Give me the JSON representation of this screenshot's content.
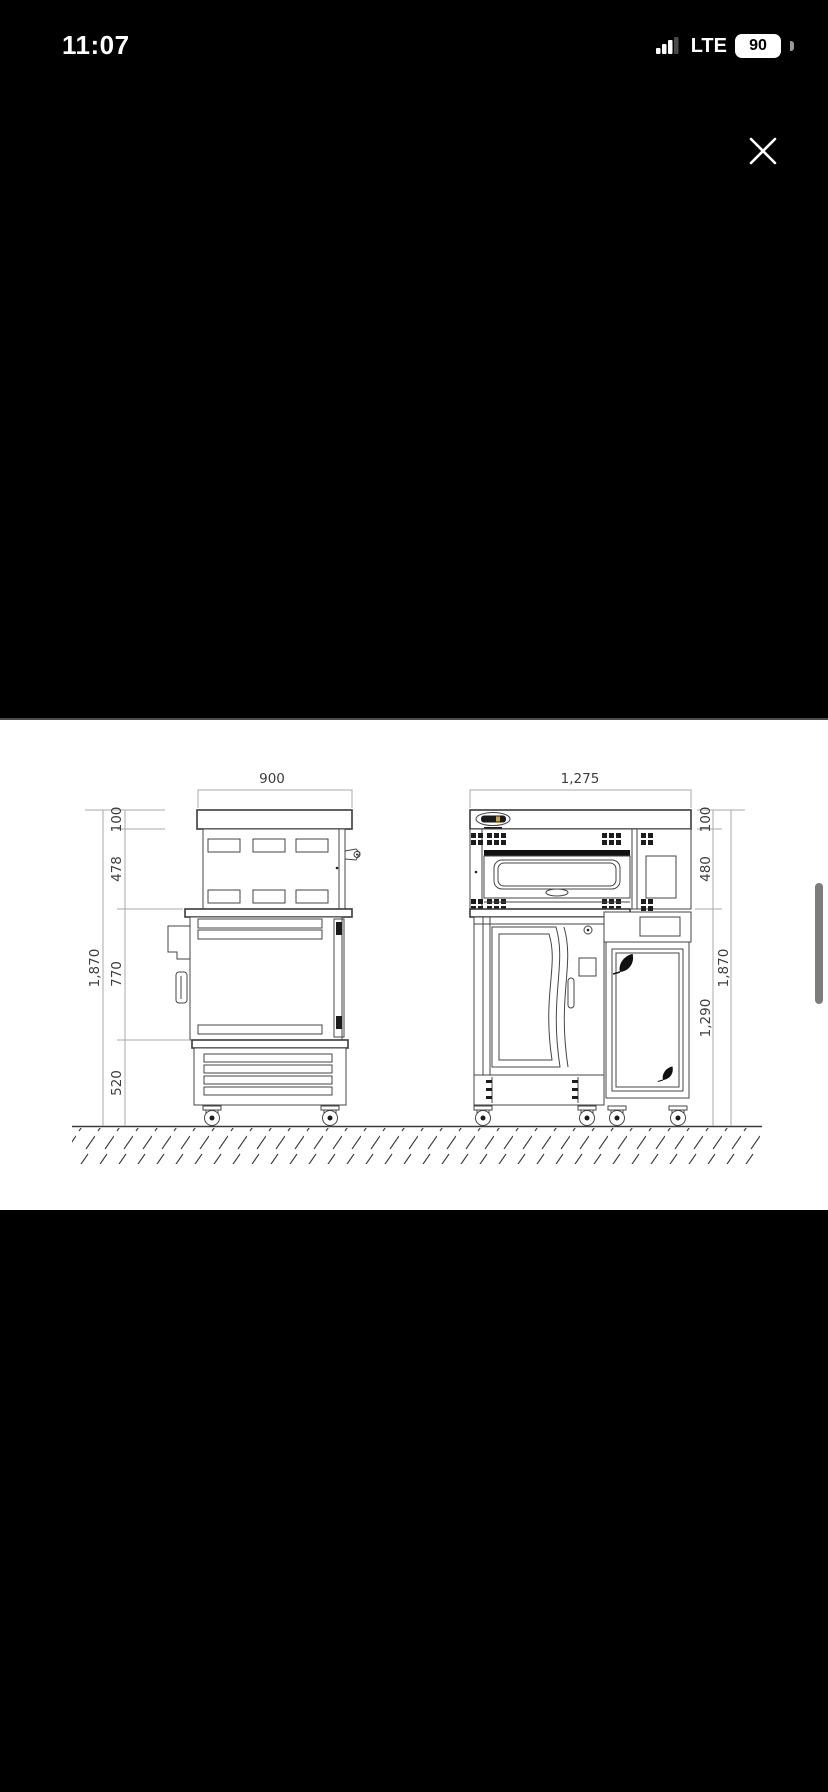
{
  "status_bar": {
    "time": "11:07",
    "network": "LTE",
    "battery_percent": "90"
  },
  "viewer": {
    "close_icon": "✕"
  },
  "drawing": {
    "description": "Dimensioned engineering drawing of bakery deck-oven unit, side and front orthographic views on hatched ground line",
    "side_view": {
      "width": "900",
      "heights": {
        "hood": "100",
        "upper": "478",
        "middle": "770",
        "base": "520",
        "total": "1,870"
      }
    },
    "front_view": {
      "width": "1,275",
      "heights": {
        "top": "100",
        "oven": "480",
        "lower": "1,290",
        "total": "1,870"
      }
    }
  }
}
